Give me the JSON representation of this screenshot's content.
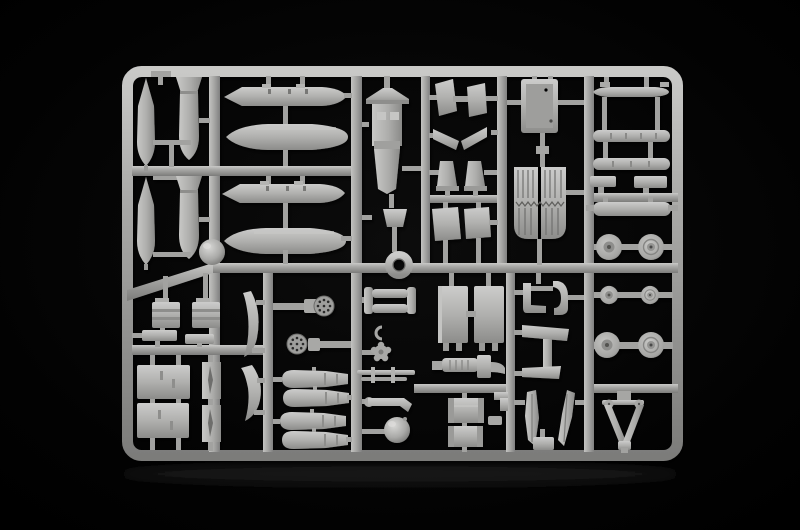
{
  "meta": {
    "type": "photograph",
    "subject": "Plastic scale-model kit sprue with unassembled grey parts on a black background",
    "description": "A light grey injection-moulded polystyrene sprue (parts frame) photographed against black. The runner grid holds bombs, drop tanks, a cockpit floor, a cockpit tub, a radiator grille, wheels, landing-gear forks, bay doors, seats, bomb halves, perforated engine discs and assorted small aircraft-model parts."
  },
  "scene": {
    "background": {
      "color": "#000000",
      "floor_shadow_color": "#161616"
    },
    "sprue": {
      "material": "injection-moulded polystyrene",
      "plastic_color": "#aeaeac",
      "highlight_color": "#d2d2d0",
      "shadow_color": "#767674",
      "frame": {
        "x": 122,
        "y": 66,
        "width": 561,
        "height": 395,
        "bar_thickness": 11,
        "corner_radius": 14
      },
      "runners": {
        "vertical_count": 7,
        "horizontal_count": 8,
        "diagonal_count": 1
      },
      "parts": [
        "aerial bomb, slender (x2)",
        "aerial bomb, finned (x2)",
        "drop tank with pylon ticks (x2)",
        "drop tank, smooth (x2)",
        "spherical ball (x2)",
        "cockpit floor with canopy deck",
        "instrument cover",
        "ring collar",
        "intake ramp pair",
        "tail wedge pair",
        "seat pedestal (x2)",
        "hatch plate (x2)",
        "cockpit tub",
        "radiator grille with slats",
        "missile body half (x3)",
        "stub pylon (x2)",
        "launcher rail",
        "main wheel (x4)",
        "small wheel (x2)",
        "landing-gear fork",
        "crew seat (x2)",
        "seat base bar (x2)",
        "bay door, large (x2)",
        "intake splitter blade (x2)",
        "curved fuselage rib (x2)",
        "perforated engine disc (x2)",
        "bomb half (x4)",
        "exhaust frame",
        "retaining clip",
        "impeller rosette",
        "push rods",
        "exhaust elbow",
        "gear strut plate (x2)",
        "ribbed actuator cylinder",
        "oil tank cylinder (x2)",
        "angle bracket",
        "gear door hook (x2)",
        "gear leg anchor",
        "canopy rail blade (x2)",
        "equipment box"
      ]
    }
  }
}
